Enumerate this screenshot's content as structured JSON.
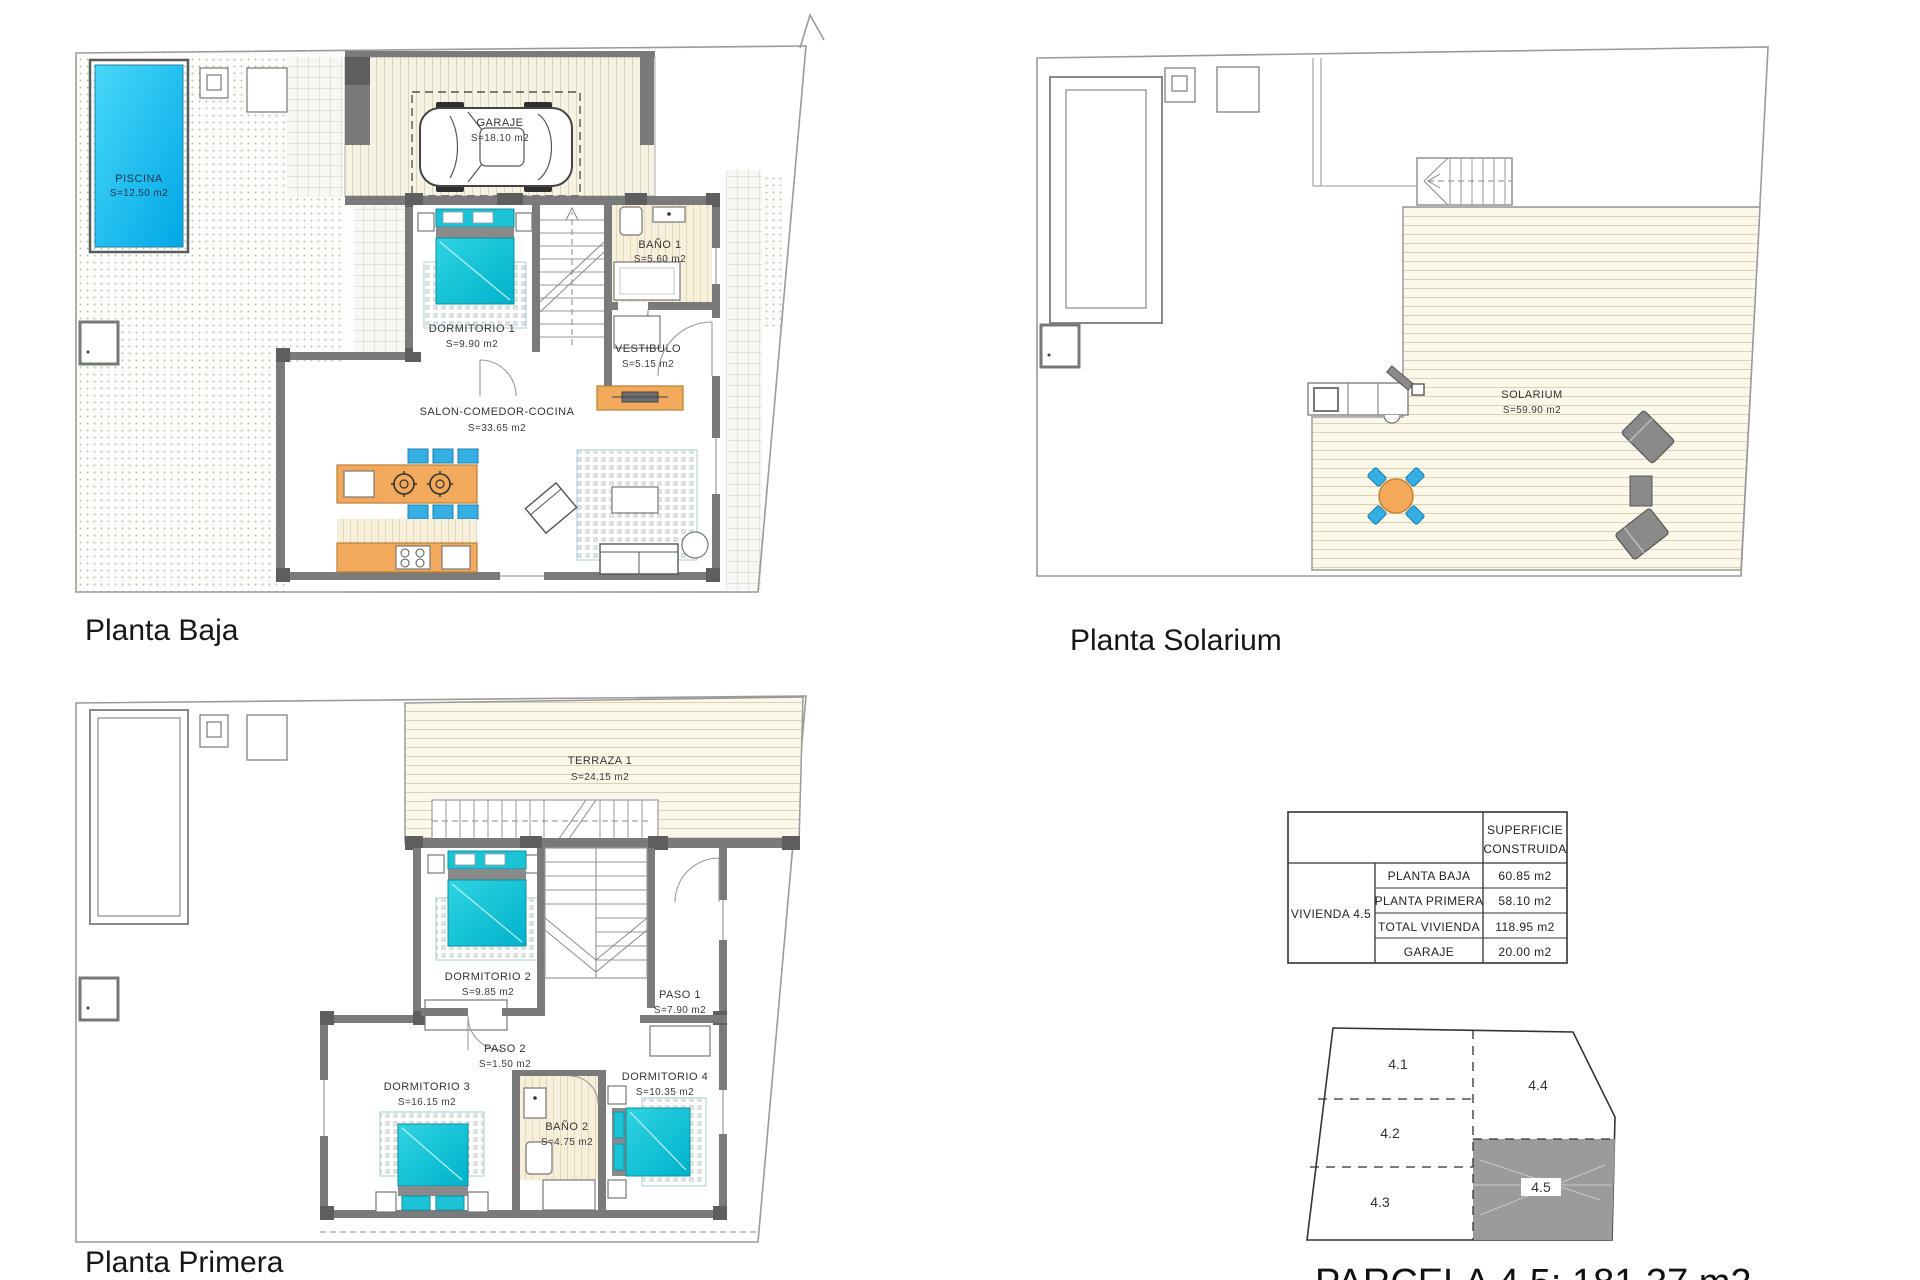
{
  "plans": {
    "baja": {
      "title": "Planta Baja",
      "rooms": {
        "piscina": {
          "name": "PISCINA",
          "area": "S=12.50 m2"
        },
        "jardin": {
          "name": "JARDIN",
          "area": "S=56.95 m2"
        },
        "garaje": {
          "name": "GARAJE",
          "area": "S=18.10 m2"
        },
        "dormitorio1": {
          "name": "DORMITORIO 1",
          "area": "S=9.90 m2"
        },
        "bano1": {
          "name": "BAÑO 1",
          "area": "S=5.60 m2"
        },
        "vestibulo": {
          "name": "VESTIBULO",
          "area": "S=5.15 m2"
        },
        "salon": {
          "name": "SALON-COMEDOR-COCINA",
          "area": "S=33.65 m2"
        }
      }
    },
    "solarium": {
      "title": "Planta Solarium",
      "rooms": {
        "solarium": {
          "name": "SOLARIUM",
          "area": "S=59.90 m2"
        }
      }
    },
    "primera": {
      "title": "Planta Primera",
      "rooms": {
        "terraza1": {
          "name": "TERRAZA 1",
          "area": "S=24.15 m2"
        },
        "dormitorio2": {
          "name": "DORMITORIO 2",
          "area": "S=9.85 m2"
        },
        "paso1": {
          "name": "PASO 1",
          "area": "S=7.90 m2"
        },
        "paso2": {
          "name": "PASO 2",
          "area": "S=1.50 m2"
        },
        "dormitorio3": {
          "name": "DORMITORIO 3",
          "area": "S=16.15 m2"
        },
        "bano2": {
          "name": "BAÑO 2",
          "area": "S=4.75 m2"
        },
        "dormitorio4": {
          "name": "DORMITORIO 4",
          "area": "S=10.35 m2"
        }
      }
    }
  },
  "surface_table": {
    "header": [
      "SUPERFICIE",
      "CONSTRUIDA"
    ],
    "row_label": "VIVIENDA 4.5",
    "rows": [
      {
        "label": "PLANTA BAJA",
        "value": "60.85 m2"
      },
      {
        "label": "PLANTA PRIMERA",
        "value": "58.10 m2"
      },
      {
        "label": "TOTAL VIVIENDA",
        "value": "118.95 m2"
      },
      {
        "label": "GARAJE",
        "value": "20.00 m2"
      }
    ]
  },
  "parcel_diagram": {
    "parcels": [
      {
        "id": "4.1",
        "highlighted": false
      },
      {
        "id": "4.2",
        "highlighted": false
      },
      {
        "id": "4.3",
        "highlighted": false
      },
      {
        "id": "4.4",
        "highlighted": false
      },
      {
        "id": "4.5",
        "highlighted": true
      }
    ],
    "caption": "PARCELA 4.5: 181.37 m2"
  },
  "colors": {
    "pool": "#29c6ef",
    "bed_cyan": "#1ac3d6",
    "furniture_wood": "#f2a95c",
    "chair_blue": "#35aee3",
    "wall_gray": "#7a7a7a",
    "garden_dot": "#aec9a8",
    "deck_cream": "#fbf8ea",
    "parcel_highlight": "#9b9b9b"
  }
}
